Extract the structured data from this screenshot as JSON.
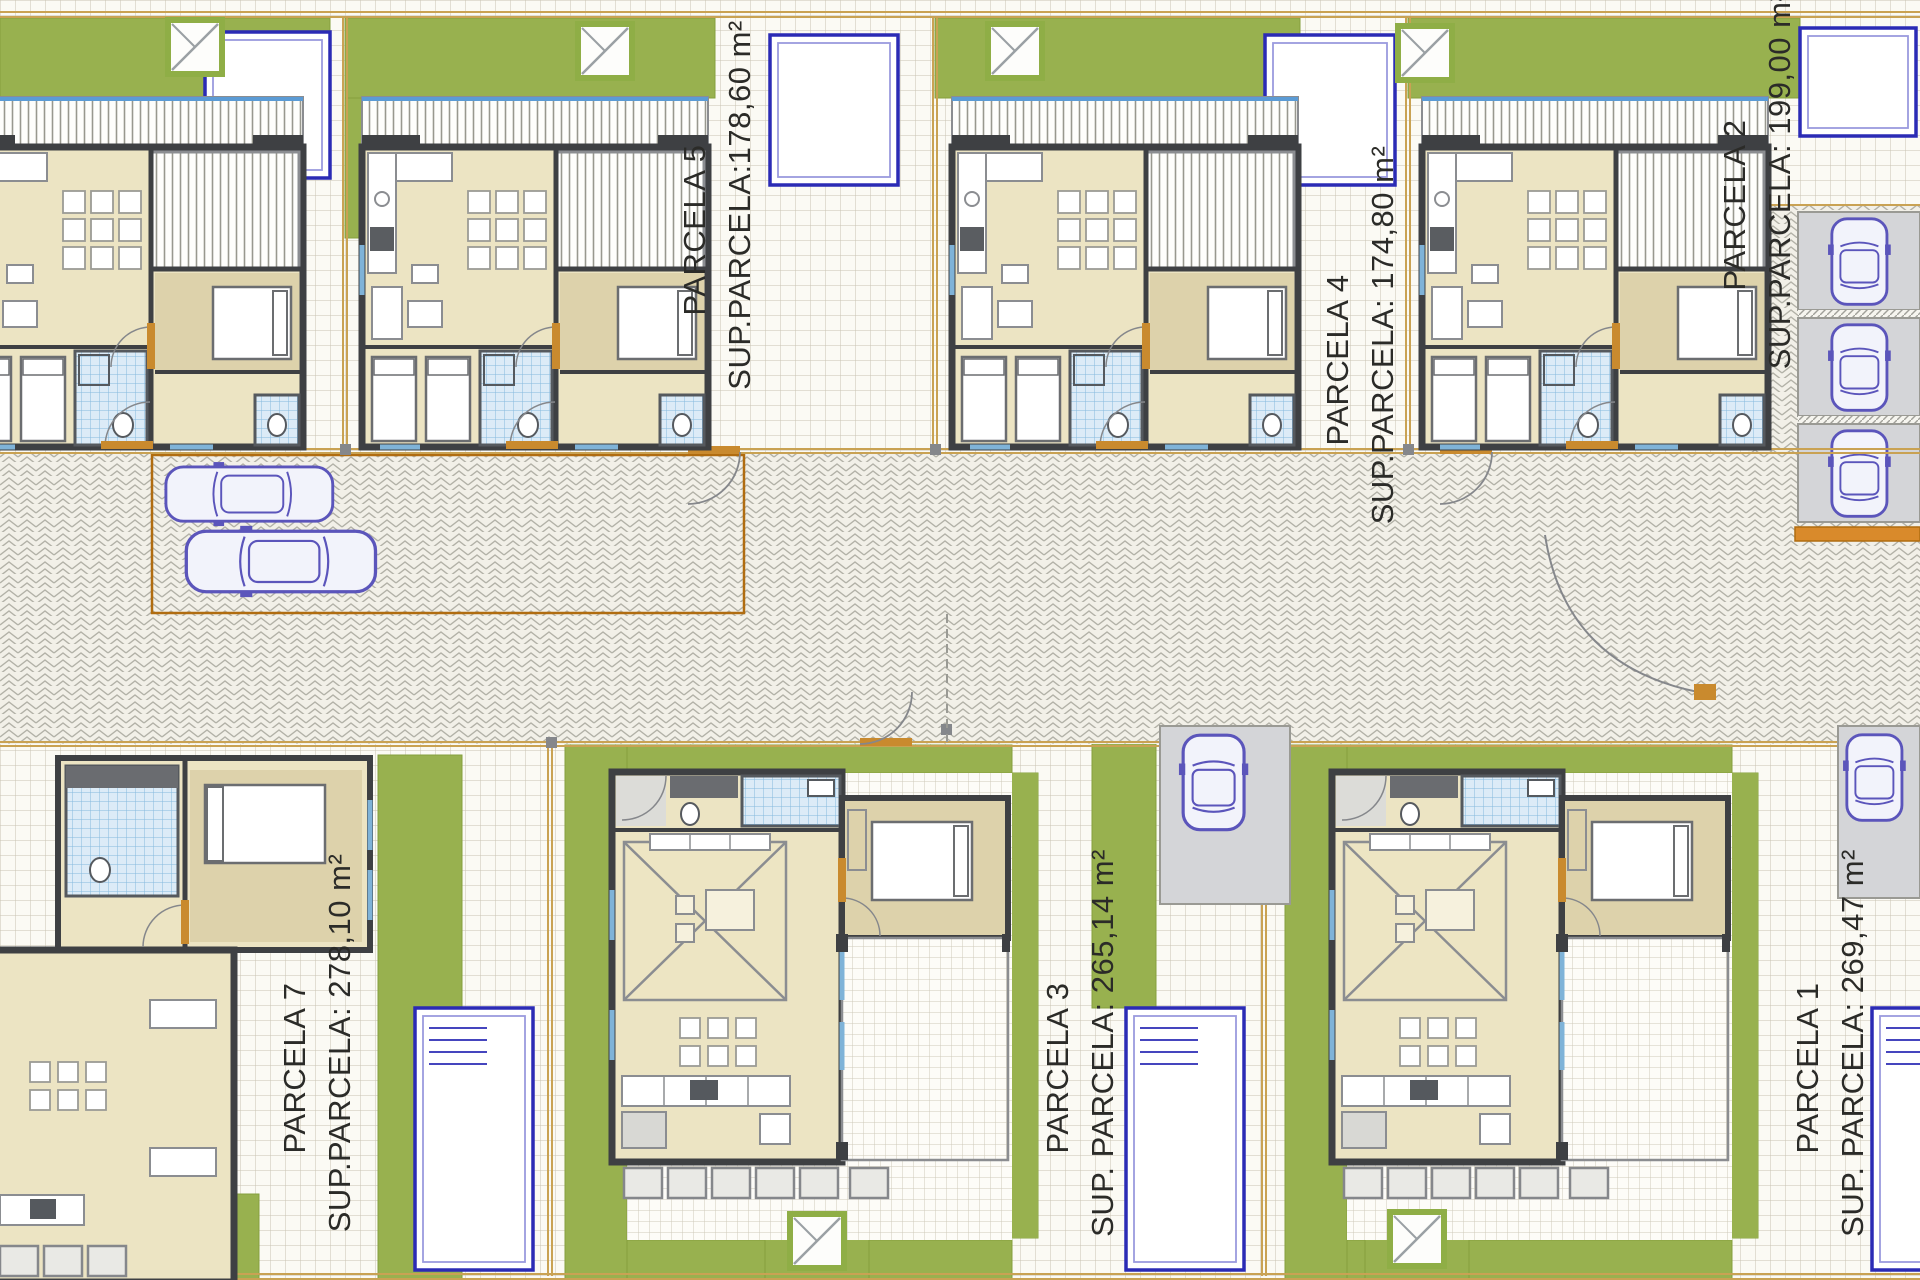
{
  "document": {
    "type": "residential-site-plan",
    "description": "Top-view architectural site plan of seven single-family villas with gardens, pools, cars and a central paved access road",
    "units": "m²"
  },
  "parcels": [
    {
      "name": "PARCELA 5",
      "area_label": "SUP.PARCELA:178,60 m²"
    },
    {
      "name": "PARCELA 4",
      "area_label": "SUP.PARCELA: 174,80 m²"
    },
    {
      "name": "PARCELA 2",
      "area_label": "SUP.PARCELA: 199,00 m²"
    },
    {
      "name": "PARCELA 7",
      "area_label": "SUP.PARCELA: 278,10 m²"
    },
    {
      "name": "PARCELA 3",
      "area_label": "SUP. PARCELA: 265,14 m²"
    },
    {
      "name": "PARCELA 1",
      "area_label": "SUP. PARCELA: 269,47 m²"
    }
  ],
  "features": {
    "pool_count": 7,
    "car_count": 7,
    "top_row_houses": 4,
    "bottom_row_houses": 3
  },
  "palette": {
    "grass": "#98b14f",
    "floor_beige": "#ece4c3",
    "floor_tan": "#ddd2ab",
    "wall_dark": "#3e4043",
    "wall_mid": "#8b8d91",
    "door_accent": "#c98a2e",
    "gate_orange": "#d98a2b",
    "tile_blue": "#85b8de",
    "pool_border": "#2b2bb5",
    "car_outline": "#5b55bb",
    "paving": "#fbfaf4",
    "road": "#f2f0e8",
    "boundary_tan": "#c9a253",
    "label_text": "#2b2b28"
  }
}
